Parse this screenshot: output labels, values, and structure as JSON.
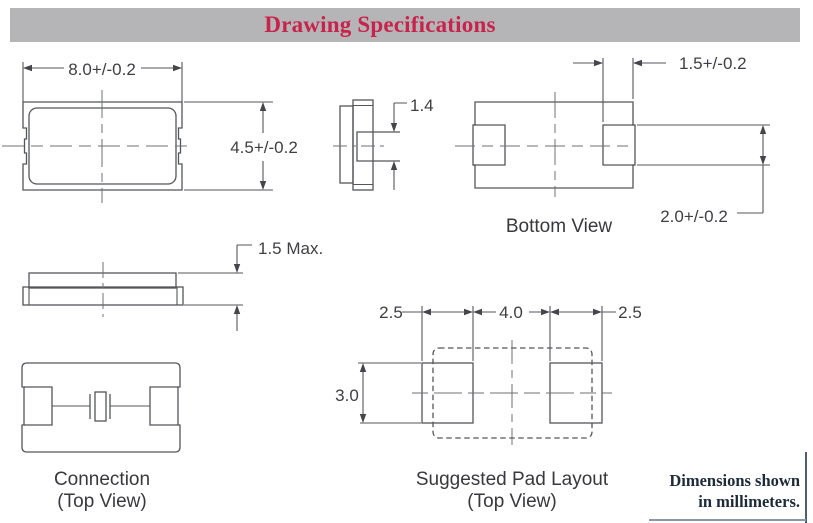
{
  "header": {
    "title": "Drawing Specifications",
    "bar_color": "#b5b4b6",
    "title_color": "#c8234c"
  },
  "drawings": {
    "top_view": {
      "width_dim": "8.0+/-0.2",
      "height_dim": "4.5+/-0.2"
    },
    "end_view": {
      "lid_dim": "1.4"
    },
    "bottom_view": {
      "caption": "Bottom View",
      "pad_width_dim": "1.5+/-0.2",
      "pad_length_dim": "2.0+/-0.2"
    },
    "side_view": {
      "height_dim": "1.5 Max."
    },
    "connection": {
      "caption": "Connection",
      "subcaption": "(Top View)"
    },
    "pad_layout": {
      "caption": "Suggested Pad Layout",
      "subcaption": "(Top View)",
      "left_pad_width": "2.5",
      "pad_spacing": "4.0",
      "right_pad_width": "2.5",
      "pad_height": "3.0"
    }
  },
  "footnote": {
    "line1": "Dimensions shown",
    "line2": "in millimeters."
  },
  "colors": {
    "drawing_line": "#55565a",
    "dimension_text": "#3e3f42",
    "footnote_text": "#1d2b39"
  }
}
